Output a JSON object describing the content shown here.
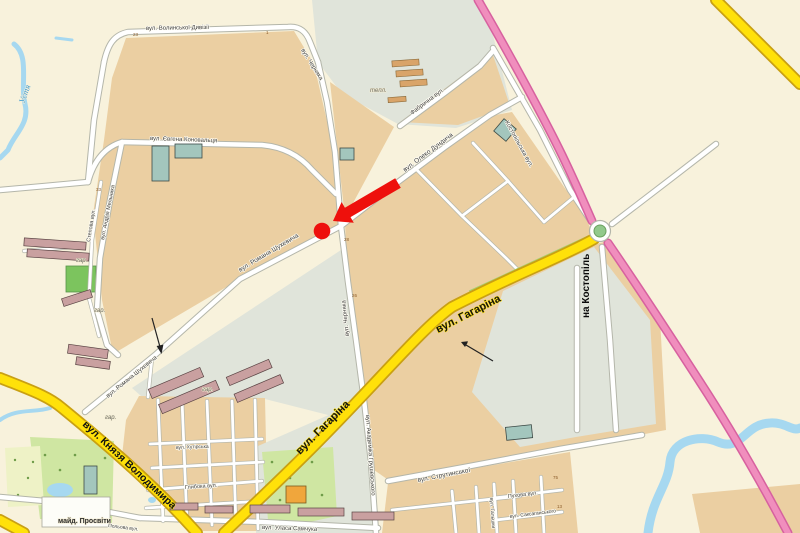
{
  "map": {
    "colors": {
      "land": "#f8f2dc",
      "built_up": "#ebcfa2",
      "industrial_gray": "#e0e4da",
      "park_green": "#cfe6a2",
      "field_green": "#7cc45e",
      "water_blue": "#a6d8f0",
      "road_white": "#ffffff",
      "road_casing": "#b4b6aa",
      "road_yellow": "#ffe10a",
      "road_yellow_casing": "#c9a013",
      "road_pink": "#f08ebd",
      "road_pink_casing": "#d7619f",
      "building_mauve": "#c9a0a0",
      "building_teal": "#a3c6bd",
      "marker_red": "#ee100c"
    },
    "streets": {
      "volynskoi_dyvizii": "вул. Волинської Дивізії",
      "chernyaka_north": "вул. Черняка",
      "chernyaka_south": "вул. Черняка",
      "konovaltsia": "вул. Євгена Коновальця",
      "melnyka": "вул. Андрія Мельника",
      "stepova": "Степова вул.",
      "shukhevycha_1": "вул. Романа Шухевича",
      "shukhevycha_2": "вул. Романа Шухевича",
      "dundycha": "вул. Олеко Дундича",
      "fabrychna": "Фабрична вул.",
      "kostopilska": "Костопільська вул.",
      "haharina_1": "вул. Гагаріна",
      "haharina_2": "вул. Гагаріна",
      "kniazia_volodymyra": "вул. Князя Володимира",
      "hrushevskoho": "вул. Академіка Грушевського",
      "strutynskoi": "вул. Струтинської",
      "pukhova": "Пухова вул.",
      "saksahanskoho": "вул. Саксаганського",
      "halshky": "вул. Гальшки",
      "ulasa_samchuka": "вул. Уласа Самчука",
      "hlyboka": "Глибока вул.",
      "khutirska": "вул. Хутірська",
      "polova": "Польова вул."
    },
    "places": {
      "maid_prosvity": "майд. Просвіти",
      "na_kostopil": "на Костопіль",
      "teplytsi": "тепл.",
      "river_ustia": "Устя",
      "har_1": "гар.",
      "har_2": "гар.",
      "har_3": "гар.",
      "har_4": "гар."
    },
    "house_numbers": [
      "23",
      "1",
      "28",
      "26",
      "33",
      "75",
      "13",
      "20"
    ]
  }
}
